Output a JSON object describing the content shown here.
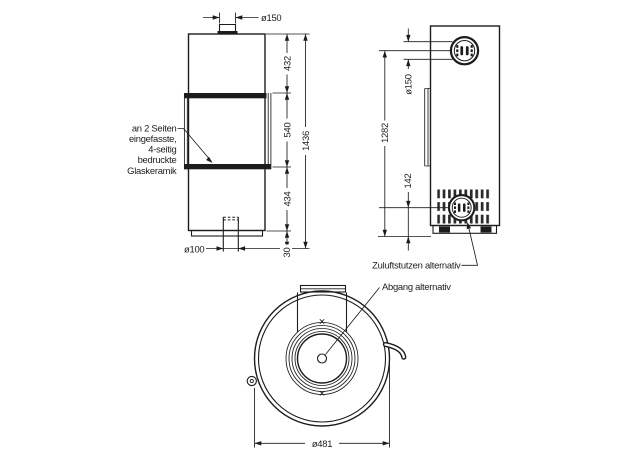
{
  "drawing": {
    "title": "stove-technical-drawing",
    "colors": {
      "line": "#1c1c1c",
      "background": "#ffffff"
    },
    "front_view": {
      "dim_flue_diameter": "ø150",
      "dim_top_section": "432",
      "dim_glass_section": "540",
      "dim_base_section": "434",
      "dim_floor_clearance": "30",
      "dim_total_height": "1436",
      "dim_air_inlet_diameter": "ø100",
      "glass_annotation_lines": [
        "an 2 Seiten",
        "eingefasste,",
        "4-seitig",
        "bedruckte",
        "Glaskeramik"
      ]
    },
    "side_view": {
      "dim_flue_diameter": "ø150",
      "dim_flue_center_height": "1282",
      "dim_air_inlet_center_height": "142",
      "label_air_inlet": "Zuluftstutzen alternativ",
      "label_flue_outlet": "Abgang alternativ"
    },
    "top_view": {
      "dim_body_diameter": "ø481"
    }
  }
}
